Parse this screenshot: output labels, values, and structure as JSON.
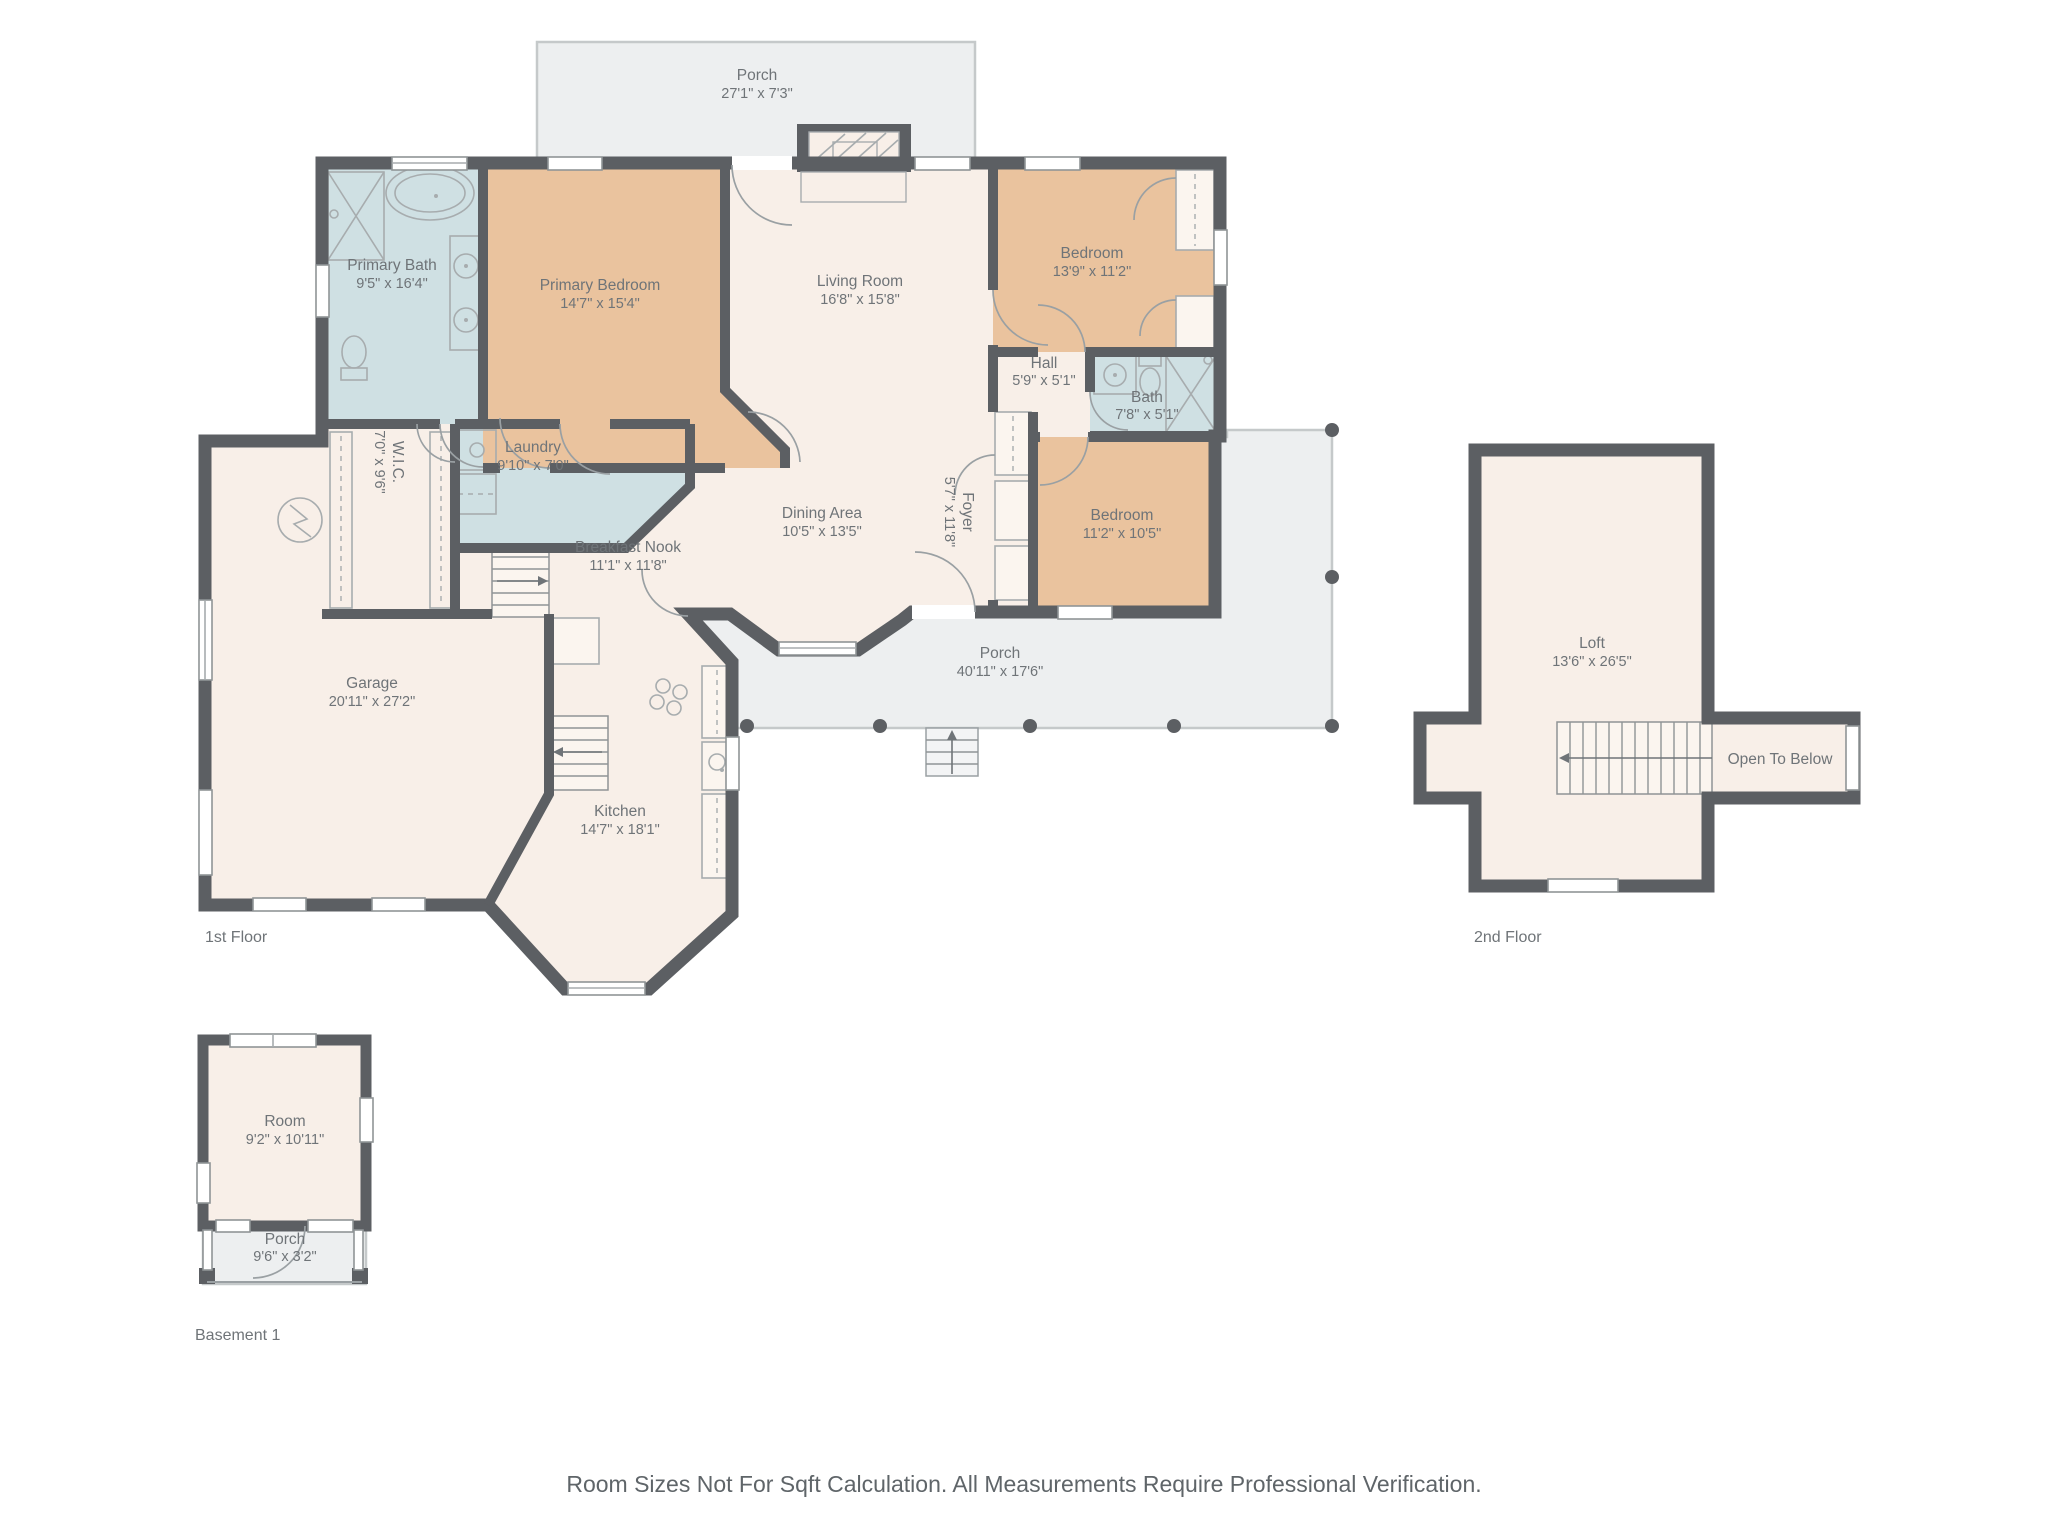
{
  "footer": {
    "text": "Room Sizes Not For Sqft Calculation. All Measurements Require Professional Verification."
  },
  "floors": {
    "first": {
      "label": "1st Floor"
    },
    "second": {
      "label": "2nd Floor"
    },
    "basement": {
      "label": "Basement 1"
    }
  },
  "rooms": {
    "porch_top": {
      "name": "Porch",
      "dims": "27'1\" x 7'3\""
    },
    "primary_bath": {
      "name": "Primary Bath",
      "dims": "9'5\" x 16'4\""
    },
    "primary_bedroom": {
      "name": "Primary Bedroom",
      "dims": "14'7\" x 15'4\""
    },
    "living_room": {
      "name": "Living Room",
      "dims": "16'8\" x 15'8\""
    },
    "bedroom_top": {
      "name": "Bedroom",
      "dims": "13'9\" x 11'2\""
    },
    "hall": {
      "name": "Hall",
      "dims": "5'9\" x 5'1\""
    },
    "bath": {
      "name": "Bath",
      "dims": "7'8\" x 5'1\""
    },
    "wic": {
      "name": "W.I.C.",
      "dims": "7'0\" x 9'6\""
    },
    "laundry": {
      "name": "Laundry",
      "dims": "9'10\" x 7'0\""
    },
    "dining": {
      "name": "Dining Area",
      "dims": "10'5\" x 13'5\""
    },
    "foyer": {
      "name": "Foyer",
      "dims": "5'7\" x 11'8\""
    },
    "bedroom_right": {
      "name": "Bedroom",
      "dims": "11'2\" x 10'5\""
    },
    "breakfast_nook": {
      "name": "Breakfast Nook",
      "dims": "11'1\" x 11'8\""
    },
    "garage": {
      "name": "Garage",
      "dims": "20'11\" x 27'2\""
    },
    "porch_wrap": {
      "name": "Porch",
      "dims": "40'11\" x 17'6\""
    },
    "kitchen": {
      "name": "Kitchen",
      "dims": "14'7\" x 18'1\""
    },
    "loft": {
      "name": "Loft",
      "dims": "13'6\" x 26'5\""
    },
    "open_to_below": {
      "name": "Open To Below"
    },
    "basement_room": {
      "name": "Room",
      "dims": "9'2\" x 10'11\""
    },
    "basement_porch": {
      "name": "Porch",
      "dims": "9'6\" x 3'2\""
    }
  },
  "colors": {
    "wall": "#5c5f63",
    "room_fill": "#f8efe8",
    "bedroom_fill": "#eac39e",
    "bath_fill": "#cfe0e3",
    "porch_fill": "#edeff0",
    "text": "#6f7478"
  }
}
